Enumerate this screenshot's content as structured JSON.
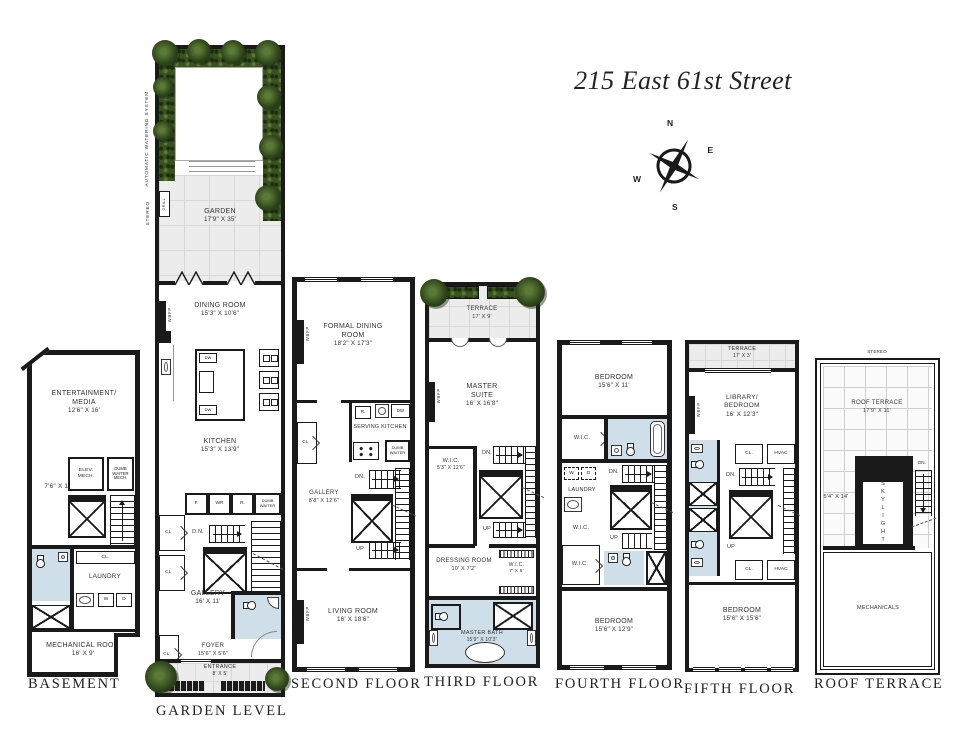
{
  "title": "215 East 61st Street",
  "compass": {
    "north": "N",
    "east": "E",
    "south": "S",
    "west": "W"
  },
  "colors": {
    "wall": "#1a1a1a",
    "bath": "#cfdfe9",
    "plant": "#33491c",
    "paving": "#ececec"
  },
  "floors": {
    "basement": {
      "label": "BASEMENT",
      "rooms": {
        "entertainment": {
          "name": "ENTERTAINMENT/ MEDIA",
          "dims": "12'6\" x 16'"
        },
        "hall_dims": "7'6\" x 12'",
        "elev_mech": "ELEV. MECH.",
        "dw_mech": "DUMB WAITER MECH.",
        "up": "UP",
        "cl": "CL.",
        "laundry": "LAUNDRY",
        "washer": "W",
        "dryer": "D",
        "mechanical": {
          "name": "MECHANICAL ROOM",
          "dims": "16' x 9'"
        }
      }
    },
    "garden": {
      "label": "GARDEN LEVEL",
      "side_notes": {
        "watering": "AUTOMATIC WATERING SYSTEM",
        "stereo": "STEREO",
        "grill": "GRILL"
      },
      "rooms": {
        "garden": {
          "name": "GARDEN",
          "dims": "17'9\" x 35'"
        },
        "dining": {
          "name": "DINING ROOM",
          "dims": "15'3\" x 10'6\""
        },
        "wbfp": "WBFP",
        "kitchen": {
          "name": "KITCHEN",
          "dims": "15'3\" x 13'9\""
        },
        "fridge": "F.",
        "wine": "WR",
        "range": "R.",
        "dumbwaiter": "DUMB WAITER",
        "dn": "D.N.",
        "cl_a": "CL.",
        "cl_b": "CL.",
        "cl_foyer": "CL.",
        "gallery": {
          "name": "GALLERY",
          "dims": "16' x 11'"
        },
        "foyer": {
          "name": "FOYER",
          "dims": "15'6\" x 5'6\""
        },
        "entrance": {
          "name": "ENTRANCE",
          "dims": "8' x 5'"
        }
      }
    },
    "second": {
      "label": "SECOND FLOOR",
      "rooms": {
        "formal_dining": {
          "name": "FORMAL DINING ROOM",
          "dims": "18'2\" x 17'3\""
        },
        "wbfp_a": "WBFP",
        "wbfp_b": "WBFP",
        "range": "R.",
        "dw": "DW",
        "serving_kitchen": "SERVING KITCHEN",
        "dumbwaiter": "DUMB WAITER",
        "cl": "CL.",
        "dn": "DN.",
        "up": "UP",
        "gallery": {
          "name": "GALLERY",
          "dims": "8'8\" x 12'6\""
        },
        "living": {
          "name": "LIVING ROOM",
          "dims": "16' x 18'6\""
        }
      }
    },
    "third": {
      "label": "THIRD FLOOR",
      "rooms": {
        "terrace": {
          "name": "TERRACE",
          "dims": "17' x 9'"
        },
        "master_suite": {
          "name": "MASTER SUITE",
          "dims": "16' x 16'8\""
        },
        "wbfp": "WBFP",
        "wic_a": {
          "name": "W.I.C.",
          "dims": "5'3\" x 12'6\""
        },
        "dn": "DN.",
        "up": "UP",
        "dressing": {
          "name": "DRESSING ROOM",
          "dims": "10' x 7'2\""
        },
        "wic_b": {
          "name": "W.I.C.",
          "dims": "7' x 6'"
        },
        "master_bath": {
          "name": "MASTER BATH",
          "dims": "15'9\" x 10'3\""
        }
      }
    },
    "fourth": {
      "label": "FOURTH FLOOR",
      "rooms": {
        "bedroom_front": {
          "name": "BEDROOM",
          "dims": "15'6\" x 11'"
        },
        "wic_a": "W.I.C.",
        "wic_b": "W.I.C.",
        "wic_c": "W.I.C.",
        "washer": "W",
        "dryer": "D",
        "laundry": "LAUNDRY",
        "dn": "DN.",
        "up": "UP",
        "bedroom_rear": {
          "name": "BEDROOM",
          "dims": "15'6\" x 12'9\""
        }
      }
    },
    "fifth": {
      "label": "FIFTH FLOOR",
      "rooms": {
        "terrace": {
          "name": "TERRACE",
          "dims": "17' x 3'"
        },
        "library": {
          "name": "LIBRARY/ BEDROOM",
          "dims": "16' x 12'3\""
        },
        "wbfp": "WBFP",
        "cl_a": "CL.",
        "hvac_a": "HVAC",
        "cl_b": "CL.",
        "hvac_b": "HVAC",
        "dn": "DN.",
        "up": "UP",
        "bedroom": {
          "name": "BEDROOM",
          "dims": "15'6\" x 15'6\""
        }
      }
    },
    "roof": {
      "label": "ROOF TERRACE",
      "side_notes": {
        "stereo": "STEREO"
      },
      "rooms": {
        "roof_terrace": {
          "name": "ROOF TERRACE",
          "dims": "17'9\" x 11'"
        },
        "side_dims": "5'4\" x 14'",
        "skylight": "SKYLIGHT",
        "dn": "DN.",
        "mechanicals": "MECHANICALS"
      }
    }
  }
}
